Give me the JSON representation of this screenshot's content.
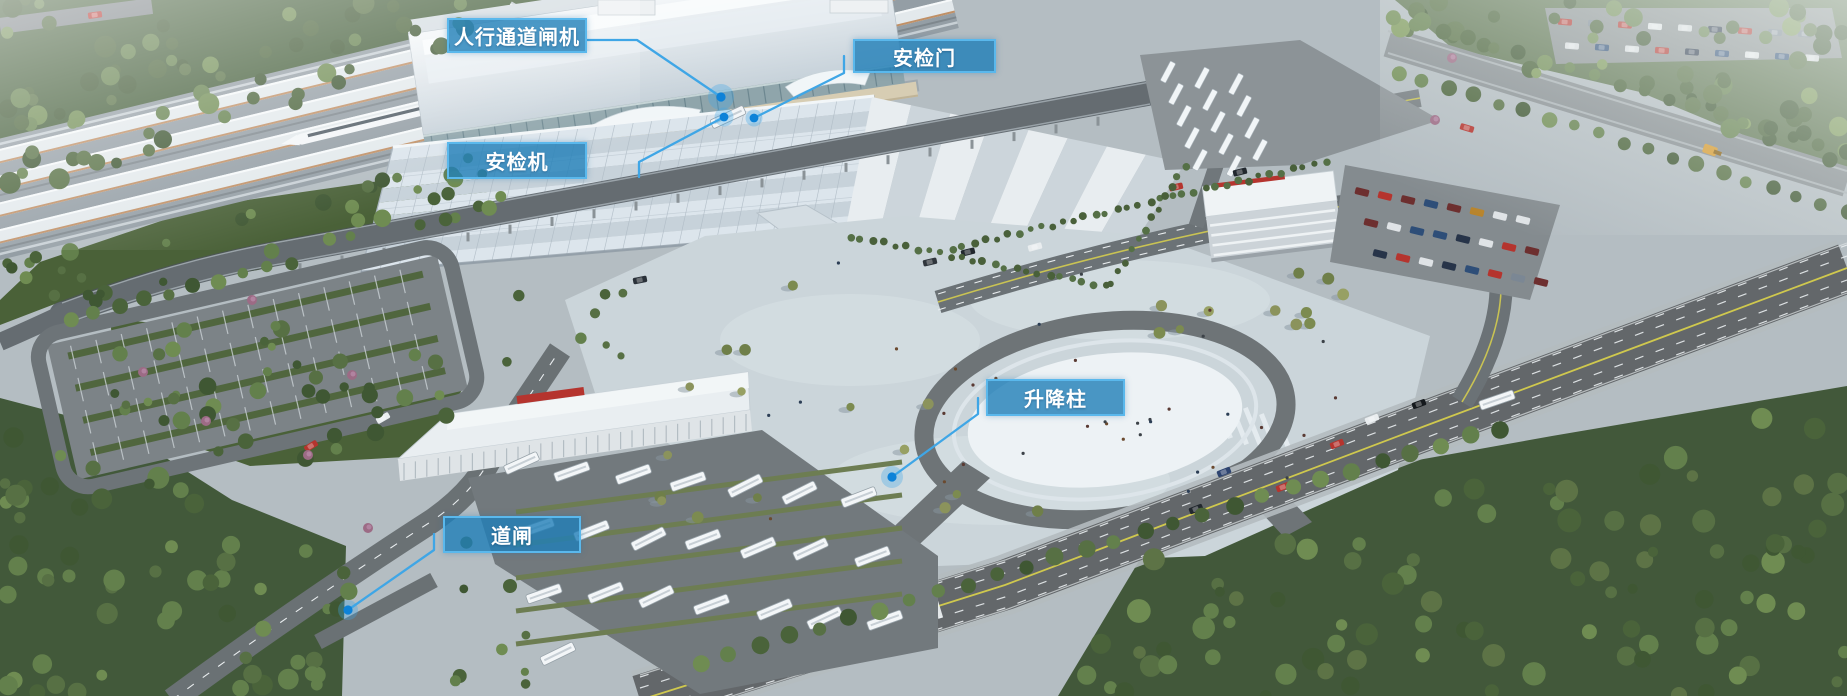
{
  "scene_kind": "station-aerial-annotated-render",
  "callouts": [
    {
      "id": "pedestrian-gate",
      "label": "人行通道闸机"
    },
    {
      "id": "security-door",
      "label": "安检门"
    },
    {
      "id": "security-scanner",
      "label": "安检机"
    },
    {
      "id": "bollard",
      "label": "升降柱"
    },
    {
      "id": "barrier-gate",
      "label": "道闸"
    }
  ],
  "colors": {
    "callout_fill": "#1f7eb8",
    "callout_border": "#5ab8ec",
    "leader_line": "#3fa6e6",
    "marker_dot": "#0d82d8",
    "label_text": "#ffffff"
  }
}
